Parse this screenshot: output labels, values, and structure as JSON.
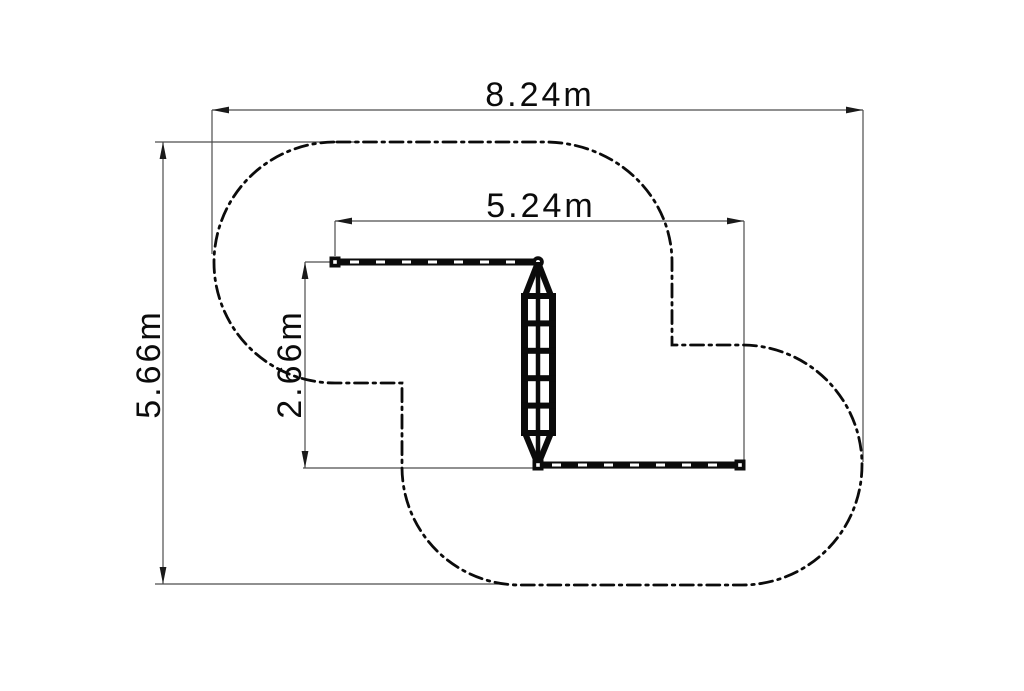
{
  "page": {
    "background": "#ffffff",
    "description": "CAD plan-view drawing of playground equipment (two balance beams connected by a climbing net) with dash-dot safety-zone boundary and four linear dimensions"
  },
  "drawing": {
    "colors": {
      "equipment_line": "#0b0b0b",
      "boundary_line": "#0b0b0b",
      "dimension_line": "#4d4d4d",
      "text": "#0b0b0b"
    },
    "styles": {
      "safety_zone_stroke": "dash-dot",
      "beam_fill": "solid black bar with white dashed centerline"
    },
    "dimensions": {
      "overall_width": {
        "label": "8.24m",
        "value_m": 8.24,
        "orientation": "horizontal",
        "measures": "safety zone overall width"
      },
      "overall_depth": {
        "label": "5.66m",
        "value_m": 5.66,
        "orientation": "vertical",
        "measures": "safety zone overall depth"
      },
      "equipment_width": {
        "label": "5.24m",
        "value_m": 5.24,
        "orientation": "horizontal",
        "measures": "equipment overall width"
      },
      "equipment_depth": {
        "label": "2.66m",
        "value_m": 2.66,
        "orientation": "vertical",
        "measures": "equipment overall depth"
      }
    },
    "elements": {
      "safety_zone_outline": "S-shaped dash-dot boundary made of two offset rounded lobes",
      "top_balance_beam": "horizontal beam, hollow square post at left end, hollow round post at right end",
      "bottom_balance_beam": "horizontal beam, hollow square posts at both ends",
      "climbing_net": "vertical net/ladder with 2 rails, 6 rungs, center rope and tapered ends"
    }
  }
}
